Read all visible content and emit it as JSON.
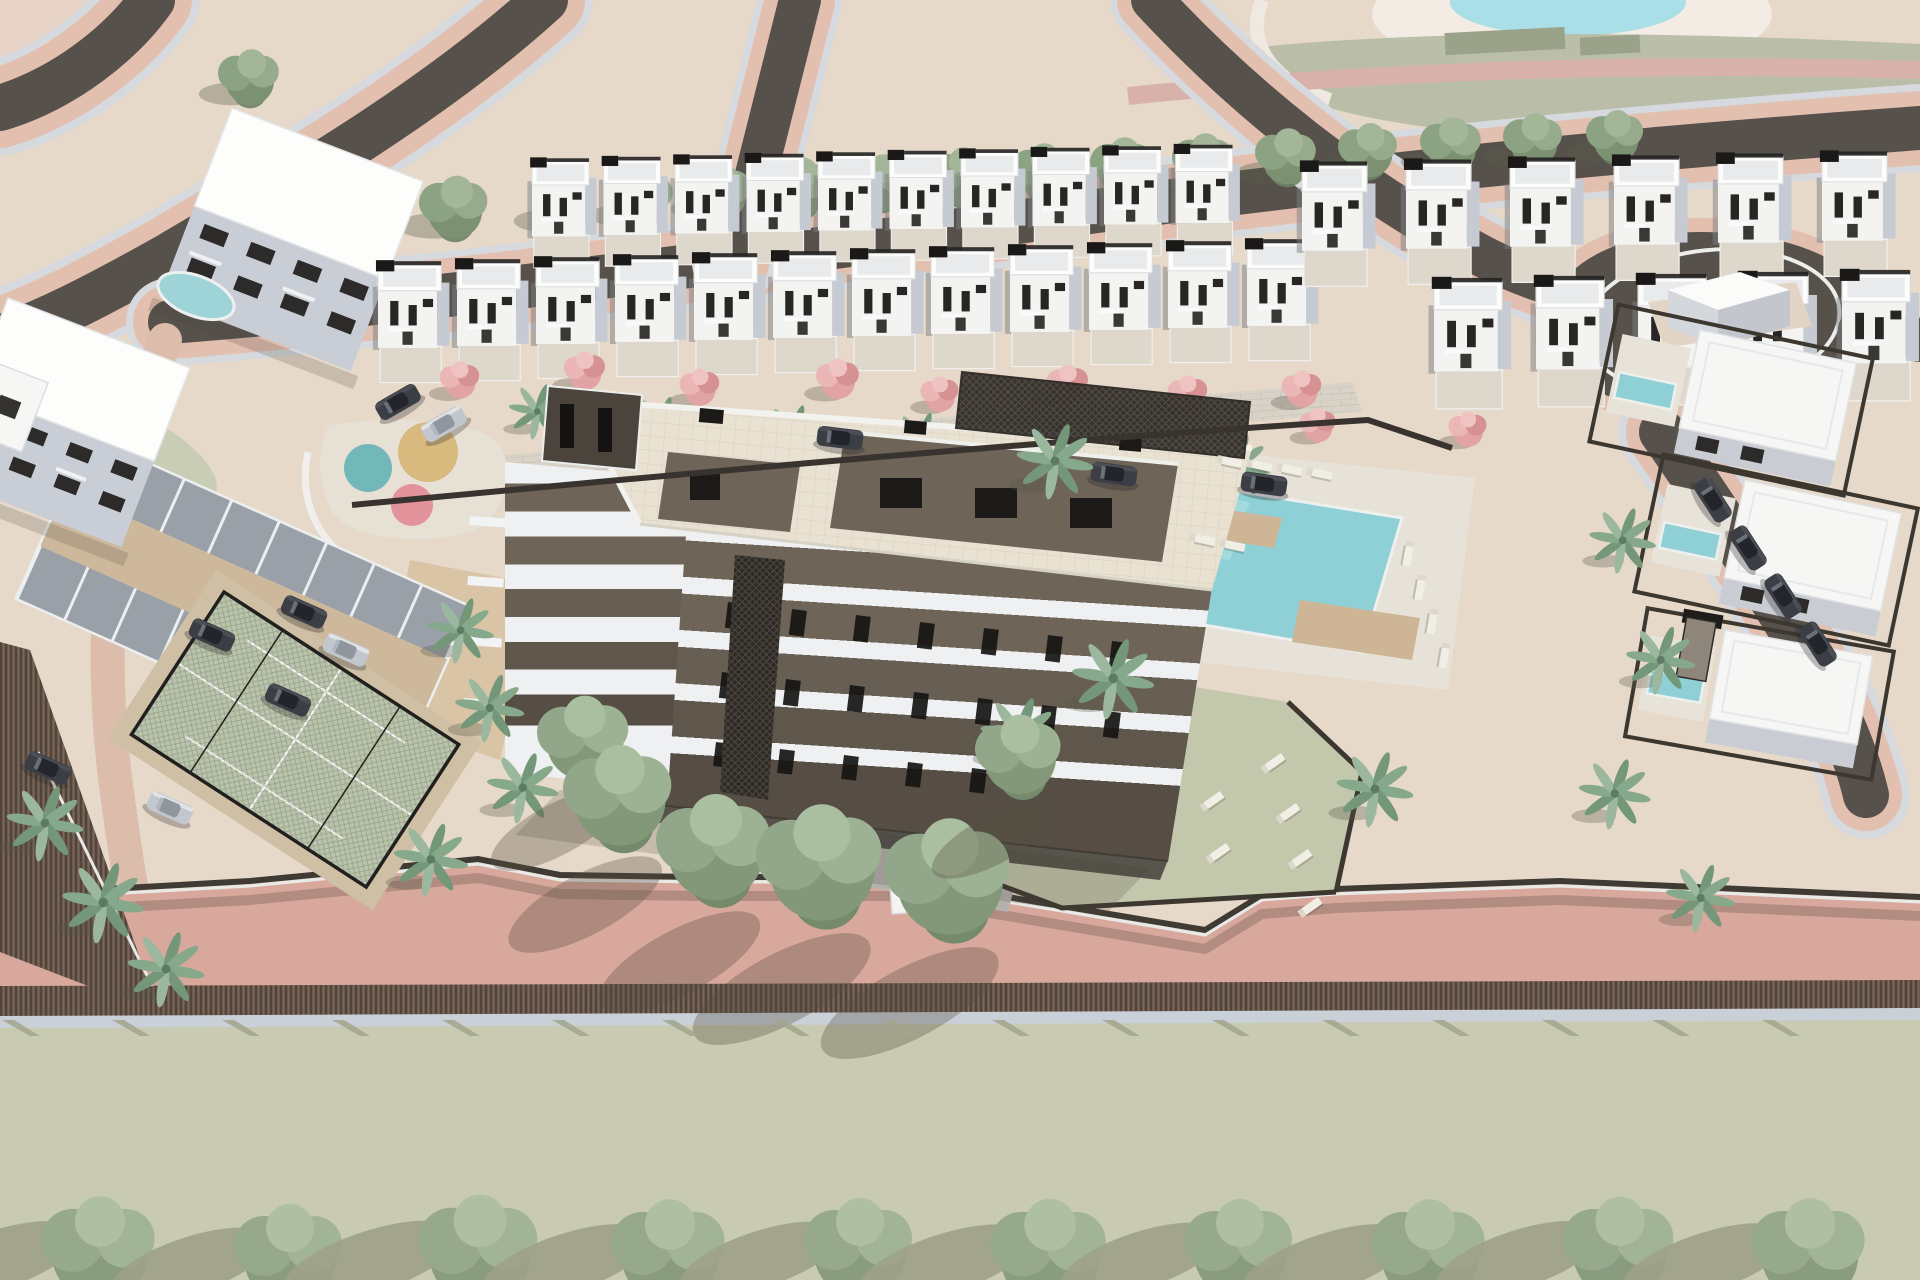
{
  "meta": {
    "description": "Aerial 3D architectural rendering of a coastal residential development: central apartment building under a tiled roof terrace with pergola, rows of white townhouses, communal pool with sun loungers, paddle court, parking lot, palm and flowering trees, perimeter promenade and roads",
    "render_type": "architectural-visualization"
  },
  "palette": {
    "ground": "#e7d9ca",
    "ground-light": "#efe2d4",
    "corner-pink": "#e9d5c8",
    "road-dark": "#57514b",
    "road-pink": "#e2bfae",
    "road-gray": "#d6d9dd",
    "salmon": "#d9a89c",
    "salmon-shade": "#c08f84",
    "hedge-brown": "#6a594d",
    "hedge-dark": "#52443a",
    "hedge-light": "#7a675a",
    "wall-light": "#cad0d8",
    "field-green": "#c8cab2",
    "field-shadow": "#a2a68b",
    "sage": "#b7bda6",
    "sage-dark": "#9aa389",
    "lawn": "#c3c7ac",
    "lawn-light": "#c9cdb5",
    "pond": "#abdfe7",
    "sand-cream": "#f2ece4",
    "house-white": "#f3f3f1",
    "house-roof": "#fcfcfb",
    "house-side": "#c6cad2",
    "house-inner": "#e8eaec",
    "window-dark": "#272624",
    "roof-black": "#1a1918",
    "terrace": "#ded8cc",
    "bldg-taupe": "#6e6458",
    "bldg-taupe-dark": "#564e44",
    "bldg-white": "#eef0f1",
    "deck-cream": "#e9e2d3",
    "deck-line": "#d9d0bd",
    "lattice-dark": "#2e2b27",
    "lattice-line": "#4d463e",
    "pool-teal": "#8fd0d6",
    "pool-teal-light": "#a6dde1",
    "deck-tan": "#cdb595",
    "pave-light": "#d8d2c7",
    "pave-line": "#c7c0b4",
    "gray-paving": "#b4b2ae",
    "parking-gray": "#9aa0a8",
    "parking-aisle": "#cdb89b",
    "stall-line": "#eceff0",
    "court-green": "#b9c4ab",
    "court-deck": "#cfc0a5",
    "court-line": "#f4f4f0",
    "cage-black": "#22201e",
    "sand-tan": "#d7c2a2",
    "play-sand": "#e7e1d5",
    "play-teal": "#72b8b8",
    "play-tan": "#d9ba7e",
    "play-pink": "#e2929b",
    "tree-green": "#7c9072",
    "tree-green2": "#8ba283",
    "tree-green3": "#96ab8c",
    "palm-green": "#86a98c",
    "palm-green2": "#74977a",
    "trunk": "#9b8d7c",
    "pink-tree": "#e2a3a4",
    "pink-tree2": "#eab7b6",
    "car-dark": "#3b3e44",
    "car-cabin": "#23252a",
    "car-silver": "#c2c7cd",
    "lounger": "#f1eee6",
    "stone-wall": "#8e867b",
    "fence-dark": "#3f3a34",
    "villa-hedge": "#3c372f",
    "pad-beige": "#e3d5c5"
  },
  "scene": {
    "counts": {
      "townhouse_rows": 4,
      "townhouses_total": 33,
      "parking_cars": 7,
      "street_cars_right": 4,
      "alley_cars": 3,
      "pools": 5,
      "paddle_courts": 1,
      "playground_circles": 3,
      "sun_loungers": 16,
      "bottom_tree_row": 10
    },
    "townhouse_rows": [
      {
        "x": 532,
        "y": 150,
        "count": 10,
        "step": 71.5,
        "dy": -1.5,
        "s": 0.92
      },
      {
        "x": 378,
        "y": 252,
        "count": 12,
        "step": 79,
        "dy": -2,
        "s": 1.02
      },
      {
        "x": 1302,
        "y": 152,
        "count": 6,
        "step": 104,
        "dy": -2,
        "s": 1.05
      },
      {
        "x": 1434,
        "y": 268,
        "count": 5,
        "step": 102,
        "dy": -2,
        "s": 1.1
      }
    ],
    "instances": [
      {
        "layer": "layer-street-trees",
        "symbol": "sym-tree",
        "name": "street-tree",
        "items": [
          [
            565,
            205,
            1.6
          ],
          [
            643,
            199,
            1.65
          ],
          [
            722,
            193,
            1.6
          ],
          [
            801,
            188,
            1.7
          ],
          [
            882,
            183,
            1.6
          ],
          [
            962,
            177,
            1.65
          ],
          [
            1043,
            172,
            1.6
          ],
          [
            1123,
            167,
            1.65
          ],
          [
            1204,
            162,
            1.6
          ],
          [
            1287,
            157,
            1.6
          ],
          [
            1369,
            151,
            1.55
          ],
          [
            1452,
            146,
            1.6
          ],
          [
            1534,
            141,
            1.55
          ],
          [
            1616,
            137,
            1.5
          ],
          [
            250,
            78,
            1.6
          ],
          [
            455,
            208,
            1.8
          ],
          [
            712,
            480,
            1.9
          ]
        ]
      },
      {
        "layer": "layer-alley-veg",
        "symbol": "sym-pink",
        "name": "flowering-tree",
        "items": [
          [
            460,
            383,
            1.2
          ],
          [
            585,
            374,
            1.25
          ],
          [
            700,
            390,
            1.2
          ],
          [
            838,
            382,
            1.3
          ],
          [
            940,
            397,
            1.15
          ],
          [
            1068,
            387,
            1.25
          ],
          [
            1188,
            397,
            1.2
          ],
          [
            1302,
            392,
            1.2
          ],
          [
            1318,
            428,
            1.1
          ],
          [
            1468,
            432,
            1.15
          ]
        ]
      },
      {
        "layer": "layer-alley-veg",
        "symbol": "sym-palm",
        "name": "street-palm",
        "items": [
          [
            535,
            418,
            1.1
          ],
          [
            658,
            432,
            1.15
          ],
          [
            790,
            442,
            1.2
          ],
          [
            918,
            448,
            1.15
          ],
          [
            1048,
            458,
            1.2
          ],
          [
            1165,
            464,
            1.15
          ],
          [
            1233,
            474,
            1.3
          ]
        ]
      },
      {
        "layer": "layer-cars",
        "symbol": "sym-car-dark",
        "name": "parked-car",
        "items": [
          [
            398,
            402,
            1,
            -30
          ],
          [
            304,
            612,
            1,
            24
          ],
          [
            288,
            700,
            1,
            24
          ],
          [
            212,
            635,
            1,
            24
          ],
          [
            48,
            768,
            1,
            24
          ],
          [
            840,
            438,
            1,
            7
          ],
          [
            1114,
            474,
            1,
            8
          ],
          [
            1264,
            484,
            1,
            8
          ],
          [
            1713,
            500,
            1,
            57
          ],
          [
            1748,
            548,
            1,
            57
          ],
          [
            1783,
            596,
            1,
            57
          ],
          [
            1818,
            644,
            1,
            57
          ]
        ]
      },
      {
        "layer": "layer-cars",
        "symbol": "sym-car-silver",
        "name": "parked-car-silver",
        "items": [
          [
            444,
            424,
            1,
            -30
          ],
          [
            346,
            650,
            1,
            24
          ],
          [
            170,
            808,
            1,
            24
          ]
        ]
      },
      {
        "layer": "layer-palms",
        "symbol": "sym-palm",
        "name": "palm-tree",
        "items": [
          [
            458,
            638,
            1.3
          ],
          [
            487,
            716,
            1.35
          ],
          [
            520,
            796,
            1.4
          ],
          [
            428,
            868,
            1.45
          ],
          [
            42,
            832,
            1.5
          ],
          [
            100,
            912,
            1.6
          ],
          [
            163,
            978,
            1.5
          ],
          [
            1052,
            470,
            1.5
          ],
          [
            1110,
            688,
            1.6
          ],
          [
            1016,
            744,
            1.5
          ],
          [
            1372,
            798,
            1.5
          ],
          [
            1620,
            548,
            1.3
          ],
          [
            1658,
            668,
            1.35
          ],
          [
            1612,
            802,
            1.4
          ],
          [
            1698,
            906,
            1.35
          ]
        ]
      },
      {
        "layer": "layer-loungers",
        "symbol": "sym-lounger",
        "name": "sun-lounger",
        "items": [
          [
            1232,
            462,
            1,
            12
          ],
          [
            1262,
            466,
            1,
            12
          ],
          [
            1292,
            470,
            1,
            12
          ],
          [
            1322,
            474,
            1,
            12
          ],
          [
            1408,
            556,
            1,
            100
          ],
          [
            1420,
            590,
            1,
            100
          ],
          [
            1432,
            624,
            1,
            100
          ],
          [
            1444,
            658,
            1,
            100
          ],
          [
            1205,
            540,
            1,
            12
          ],
          [
            1235,
            546,
            1,
            12
          ],
          [
            1275,
            762,
            1,
            -35
          ],
          [
            1290,
            812,
            1,
            -35
          ],
          [
            1302,
            858,
            1,
            -35
          ],
          [
            1214,
            800,
            1,
            -35
          ],
          [
            1220,
            852,
            1,
            -35
          ],
          [
            1312,
            906,
            1,
            -35
          ]
        ]
      },
      {
        "layer": "layer-base-trees",
        "symbol": "sym-ptree",
        "name": "promenade-tree",
        "items": [
          [
            585,
            742,
            1.6
          ],
          [
            620,
            800,
            1.9
          ],
          [
            716,
            852,
            2.0
          ],
          [
            822,
            868,
            2.2
          ],
          [
            950,
            882,
            2.2
          ],
          [
            1020,
            758,
            1.5
          ]
        ]
      },
      {
        "layer": "layer-field-shadows",
        "symbol": "sym-fieldshadow",
        "name": "fence-shadow-stripe",
        "items": [
          [
            30,
            1036,
            1
          ],
          [
            140,
            1036,
            1
          ],
          [
            250,
            1036,
            1
          ],
          [
            360,
            1036,
            1
          ],
          [
            470,
            1036,
            1
          ],
          [
            580,
            1036,
            1
          ],
          [
            690,
            1036,
            1
          ],
          [
            800,
            1036,
            1
          ],
          [
            910,
            1036,
            1
          ],
          [
            1020,
            1036,
            1
          ],
          [
            1130,
            1036,
            1
          ],
          [
            1240,
            1036,
            1
          ],
          [
            1350,
            1036,
            1
          ],
          [
            1460,
            1036,
            1
          ],
          [
            1570,
            1036,
            1
          ],
          [
            1680,
            1036,
            1
          ],
          [
            1790,
            1036,
            1
          ]
        ]
      },
      {
        "layer": "layer-bottom-trees",
        "symbol": "sym-btree",
        "name": "avenue-tree",
        "items": [
          [
            100,
            1253,
            2.1
          ],
          [
            290,
            1258,
            2.0
          ],
          [
            480,
            1254,
            2.2
          ],
          [
            670,
            1256,
            2.1
          ],
          [
            860,
            1252,
            2.0
          ],
          [
            1050,
            1257,
            2.15
          ],
          [
            1240,
            1253,
            2.0
          ],
          [
            1430,
            1256,
            2.1
          ],
          [
            1620,
            1252,
            2.05
          ],
          [
            1810,
            1255,
            2.1
          ]
        ]
      }
    ]
  }
}
